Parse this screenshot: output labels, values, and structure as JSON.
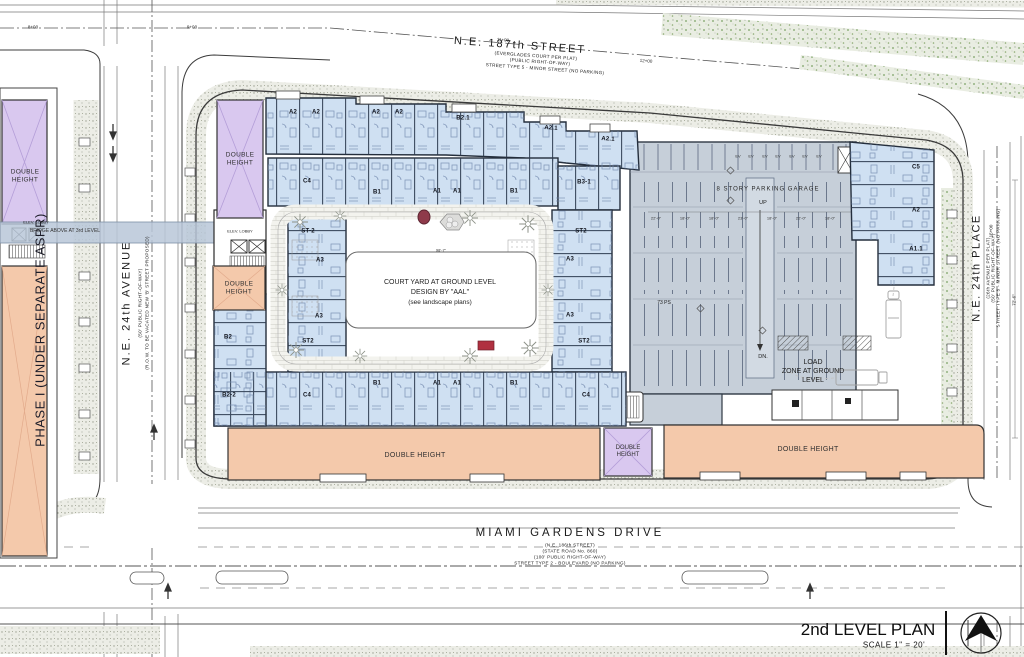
{
  "title_block": {
    "title": "2nd LEVEL PLAN",
    "scale": "SCALE  1\" = 20'"
  },
  "streets": {
    "top": {
      "name": "N.E. 187th STREET",
      "sub1": "(EVERGLADES COURT PER PLAT)",
      "sub2": "(PUBLIC RIGHT-OF-WAY)",
      "sub3": "STREET TYPE 5 - MINOR STREET (NO PARKING)"
    },
    "left": {
      "name": "N.E. 24th AVENUE",
      "sub1": "(50' PUBLIC RIGHT-OF-WAY)",
      "sub2": "(R.O.W. TO BE VACATED NEW 'B' STREET PROPOSED)"
    },
    "right": {
      "name": "N.E. 24th PLACE",
      "sub1": "(26th AVENUE PER PLAT)",
      "sub2": "(50' PUBLIC RIGHT-OF-WAY)",
      "sub3": "STREET TYPE 5 - MINOR STREET (NO PARKING)"
    },
    "bottom": {
      "name": "MIAMI GARDENS DRIVE",
      "sub1": "(N.E. 186th STREET)",
      "sub2": "(STATE ROAD No. 860)",
      "sub3": "(100' PUBLIC RIGHT-OF-WAY)",
      "sub4": "STREET TYPE 2 - BOULEVARD (NO PARKING)"
    }
  },
  "stations": {
    "s8": "8+00",
    "s9": "9+00",
    "s11": "11+00",
    "s12": "12+00",
    "s15": "15+00"
  },
  "phase1": {
    "label": "PHASE I (UNDER SEPARATE ASPR)",
    "double_height": "DOUBLE HEIGHT",
    "elev_lobby": "ELEV. LOBBY"
  },
  "bridge": {
    "label": "BRIDGE ABOVE AT 3rd LEVEL"
  },
  "main_building": {
    "elev_lobby": "ELEV. LOBBY",
    "double_height": "DOUBLE HEIGHT"
  },
  "courtyard": {
    "line1": "COURT YARD AT GROUND LEVEL",
    "line2": "DESIGN BY \"AAL\"",
    "line3": "(see landscape plans)",
    "width_dim": "98'-7\""
  },
  "garage": {
    "title": "8 STORY PARKING GARAGE",
    "up": "UP",
    "down": "DN.",
    "spaces": "73 PS",
    "ev": "EV",
    "dims": [
      "22'-0\"",
      "18'-0\"",
      "18'-0\"",
      "23'-0\"",
      "18'-0\"",
      "22'-0\"",
      "18'-0\""
    ]
  },
  "load_zone": {
    "line1": "LOAD",
    "line2": "ZONE AT GROUND",
    "line3": "LEVEL"
  },
  "dims": {
    "right_side": "72'-6\""
  },
  "units": {
    "top_row": [
      "A2",
      "A2",
      "A2",
      "A2",
      "B2.1",
      "A2.1",
      "A2.1"
    ],
    "inner_top": [
      "C4",
      "B1",
      "A1",
      "A1",
      "B1",
      "B3-1"
    ],
    "west_outer": [
      "B2",
      "B2-2"
    ],
    "west_inner": [
      "ST-2",
      "A3",
      "A3",
      "ST2"
    ],
    "east_inner": [
      "ST2",
      "A3",
      "A3",
      "ST2"
    ],
    "inner_bottom": [
      "C4",
      "B1",
      "A1",
      "A1",
      "B1",
      "C4"
    ],
    "right_col": [
      "C5",
      "A2",
      "A1.1"
    ]
  }
}
